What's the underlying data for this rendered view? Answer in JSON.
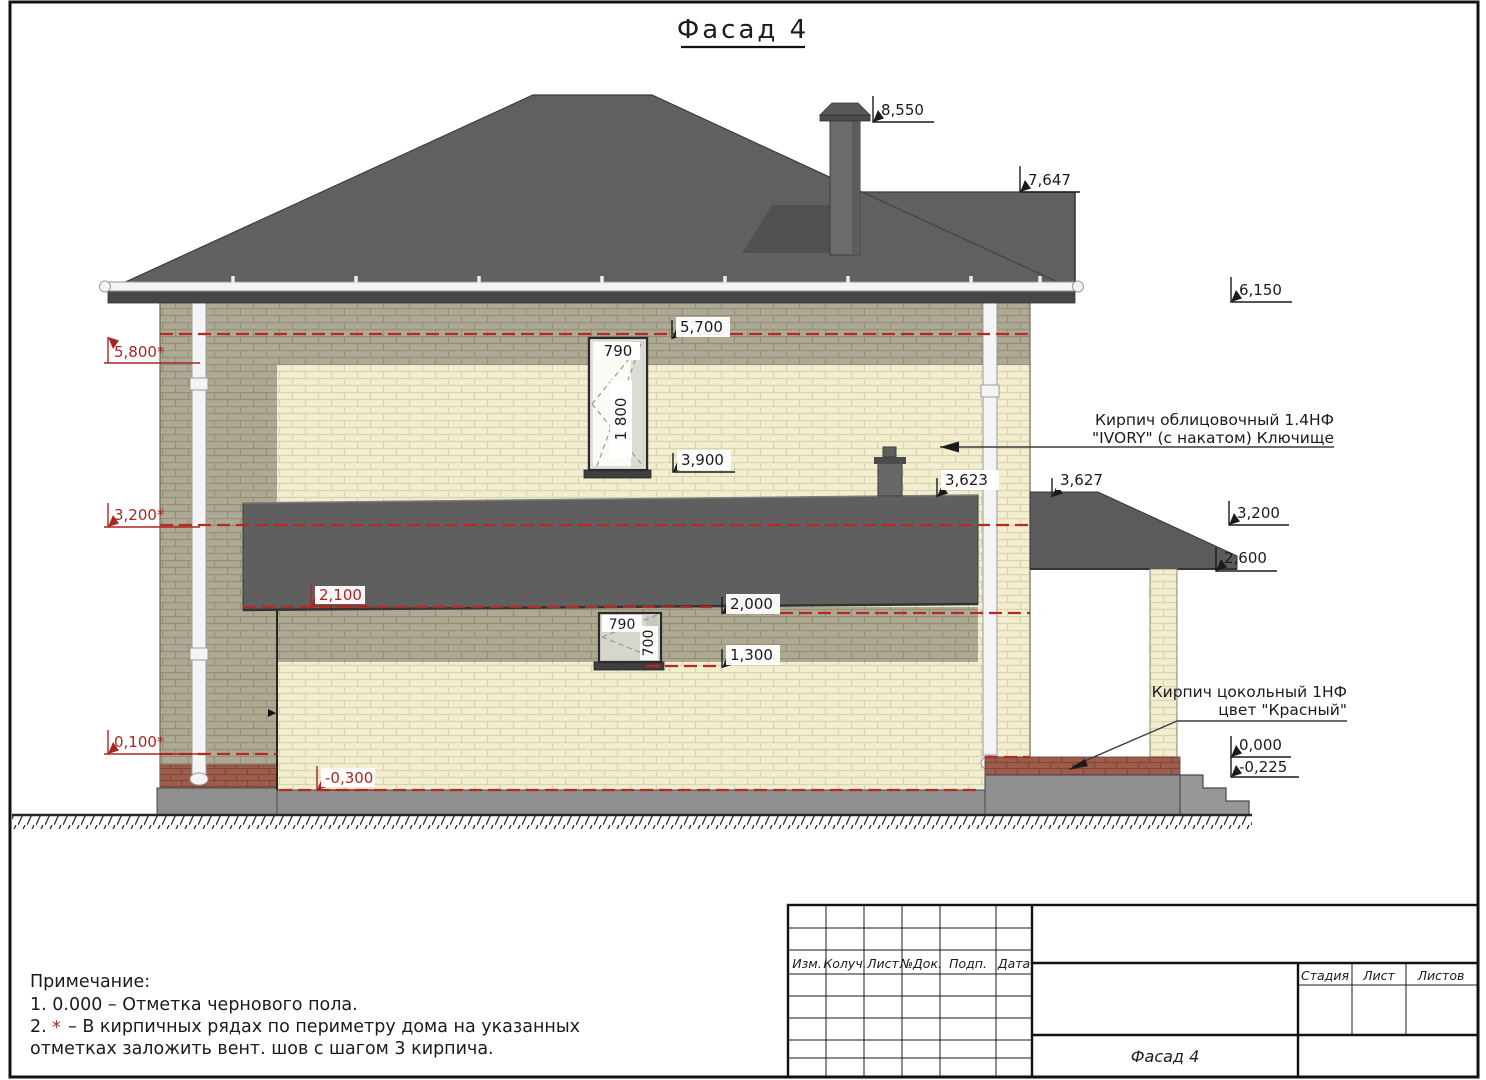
{
  "title": "Фасад 4",
  "levels": {
    "chimney_top": "8,550",
    "rear_ridge": "7,647",
    "eaves": "6,150",
    "vent_row_top": "5,800*",
    "window2_head": "5,700",
    "window2_sill": "3,900",
    "bay_roof_top": "3,623",
    "porch_roof_top": "3,627",
    "vent_row_mid": "3,200*",
    "porch_roof_mid": "3,200",
    "porch_roof_edge": "2,600",
    "bay_roof_bottom": "2,100",
    "window1_head": "2,000",
    "window1_sill": "1,300",
    "vent_row_bottom": "0,100*",
    "porch_floor": "0,000",
    "porch_floor_bottom": "-0,225",
    "plinth_bottom": "-0,300"
  },
  "windows": {
    "upper_width": "790",
    "upper_height": "1 800",
    "lower_width": "790",
    "lower_height": "700"
  },
  "annotations": {
    "facing_brick_line1": "Кирпич облицовочный 1.4НФ",
    "facing_brick_line2": "\"IVORY\" (с накатом) Ключище",
    "base_brick_line1": "Кирпич цокольный 1НФ",
    "base_brick_line2": "цвет \"Красный\""
  },
  "notes": {
    "heading": "Примечание:",
    "item1": "1. 0.000 – Отметка чернового пола.",
    "item2_prefix": "2.",
    "item2_star": "*",
    "item2_text": "– В кирпичных рядах по периметру дома на указанных",
    "item2_cont": "отметках заложить вент. шов с шагом 3 кирпича."
  },
  "titleblock": {
    "col_izm": "Изм.",
    "col_koluch": "Колуч.",
    "col_list": "Лист",
    "col_ndok": "№Док.",
    "col_podp": "Подп.",
    "col_data": "Дата",
    "stadia": "Стадия",
    "list": "Лист",
    "listov": "Листов",
    "drawing_name": "Фасад 4"
  },
  "colors": {
    "roof": "#606060",
    "brick_light": "#f2eecf",
    "brick_shadow": "#ada994",
    "brick_red": "#9e5c4a",
    "level_red": "#a82723",
    "foundation": "#8f8f8f"
  }
}
